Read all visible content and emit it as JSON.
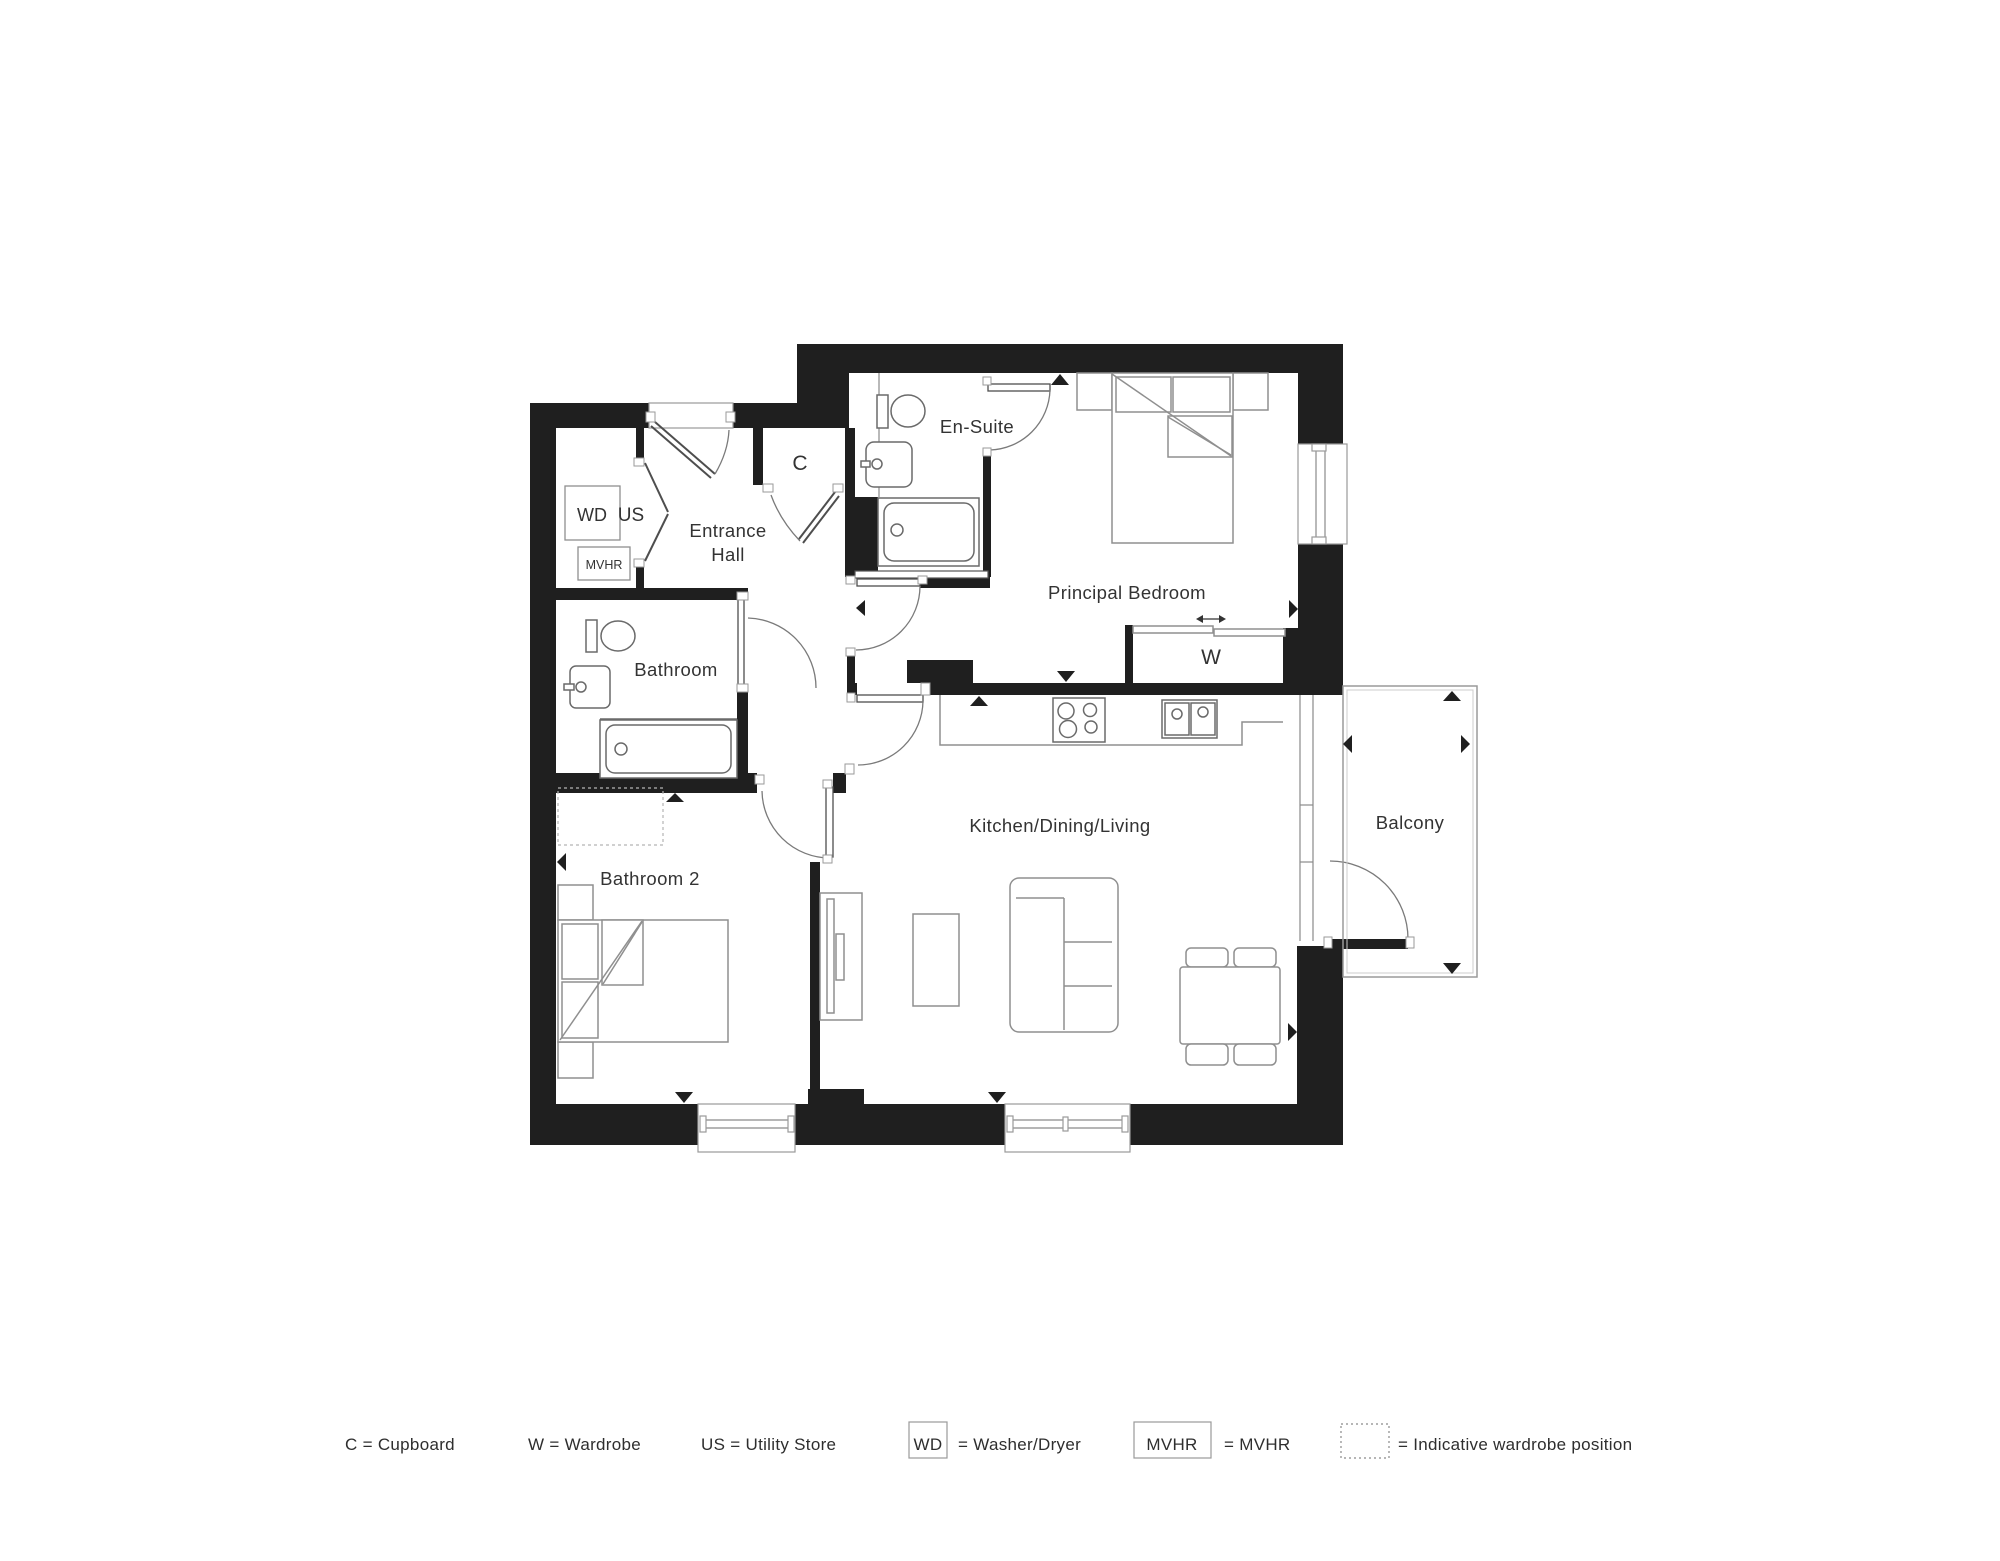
{
  "floorplan": {
    "rooms": {
      "entrance_hall_line1": "Entrance",
      "entrance_hall_line2": "Hall",
      "en_suite": "En-Suite",
      "principal_bedroom": "Principal Bedroom",
      "bathroom": "Bathroom",
      "bathroom_2": "Bathroom 2",
      "kitchen_dining_living": "Kitchen/Dining/Living",
      "balcony": "Balcony"
    },
    "markers": {
      "cupboard": "C",
      "wardrobe": "W",
      "utility_store": "US",
      "washer_dryer": "WD",
      "mvhr": "MVHR"
    }
  },
  "legend": {
    "cupboard": "C = Cupboard",
    "wardrobe": "W = Wardrobe",
    "utility_store": "US = Utility Store",
    "washer_dryer_abbr": "WD",
    "washer_dryer_text": "= Washer/Dryer",
    "mvhr_abbr": "MVHR",
    "mvhr_text": "= MVHR",
    "indicative_text": "= Indicative wardrobe position"
  },
  "colors": {
    "wall": "#1f1f1f",
    "furniture_line": "#8f8f8f",
    "text": "#333333",
    "background": "#ffffff"
  }
}
